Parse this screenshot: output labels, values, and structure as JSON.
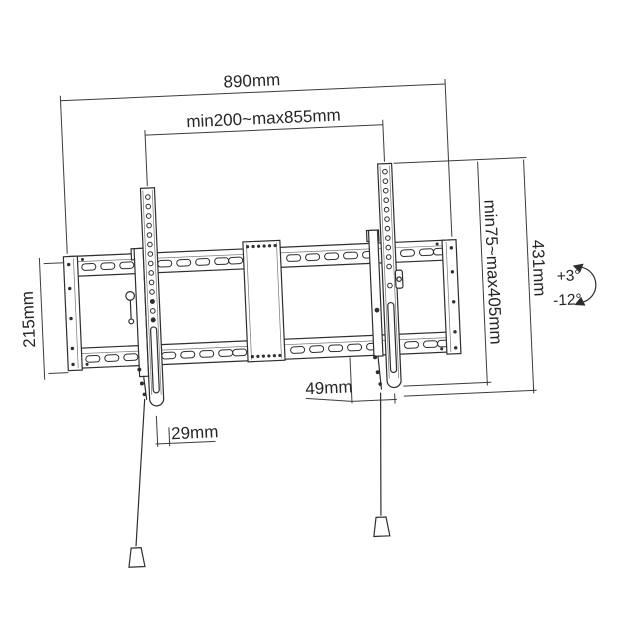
{
  "diagram": {
    "stroke_color": "#2e2e2e",
    "dimensions": {
      "overall_width": "890mm",
      "mounting_width_range": "min200~max855mm",
      "plate_height": "215mm",
      "vesa_height_range": "min75~max405mm",
      "bracket_height": "431mm",
      "depth": "49mm",
      "bottom_offset": "29mm"
    },
    "tilt": {
      "up": "+3°",
      "down": "-12°"
    }
  }
}
